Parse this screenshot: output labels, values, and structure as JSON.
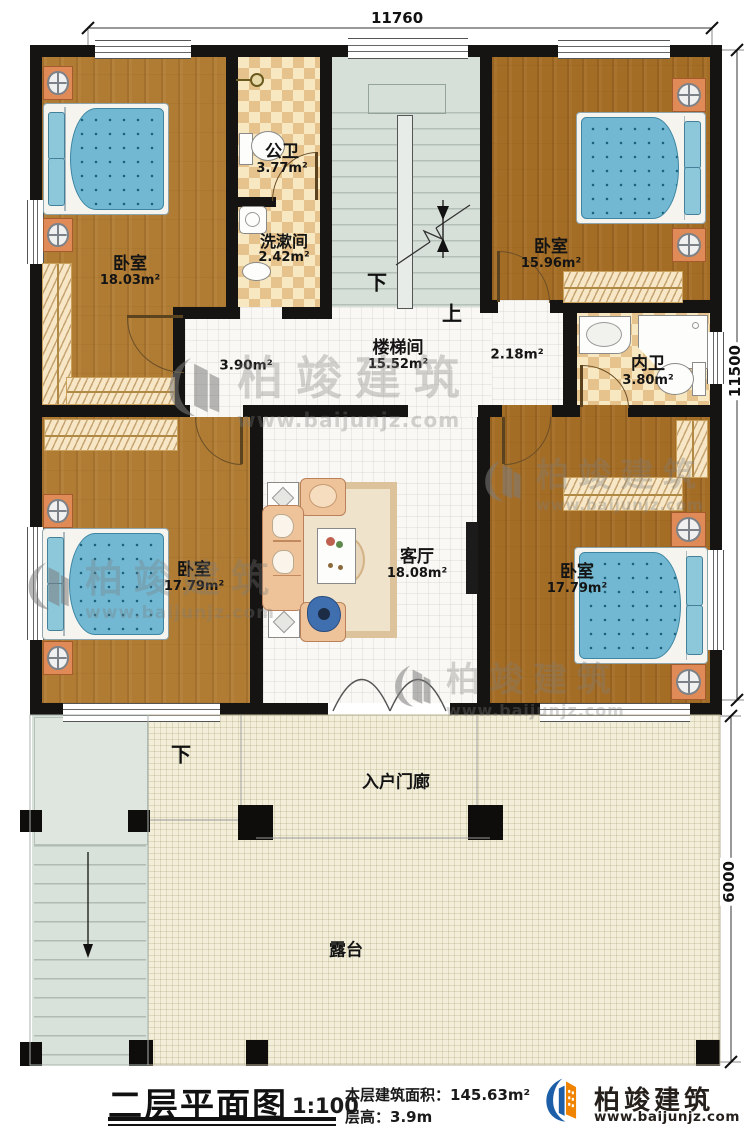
{
  "plan": {
    "title": "二层平面图",
    "scale": "1:100",
    "area_label": "本层建筑面积：",
    "area_value": "145.63m²",
    "height_label": "层高：",
    "height_value": "3.9m"
  },
  "brand": {
    "name": "柏竣建筑",
    "website": "www.baijunjz.com"
  },
  "watermark": {
    "name": "柏竣建筑",
    "website": "www.baijunjz.com"
  },
  "dimensions": {
    "top": "11760",
    "right_upper": "11500",
    "right_lower": "6000"
  },
  "rooms": {
    "bedroom_tl": {
      "name": "卧室",
      "area": "18.03m²"
    },
    "public_bath": {
      "name": "公卫",
      "area": "3.77m²"
    },
    "washroom": {
      "name": "洗漱间",
      "area": "2.42m²"
    },
    "bedroom_tr": {
      "name": "卧室",
      "area": "15.96m²"
    },
    "stair_hall": {
      "name": "楼梯间",
      "area": "15.52m²"
    },
    "corridor_left": {
      "area": "3.90m²"
    },
    "corridor_right": {
      "area": "2.18m²"
    },
    "ensuite_bath": {
      "name": "内卫",
      "area": "3.80m²"
    },
    "bedroom_bl": {
      "name": "卧室",
      "area": "17.79m²"
    },
    "living_room": {
      "name": "客厅",
      "area": "18.08m²"
    },
    "bedroom_br": {
      "name": "卧室",
      "area": "17.79m²"
    },
    "porch": {
      "name": "入户门廊"
    },
    "terrace": {
      "name": "露台"
    }
  },
  "stairs": {
    "down": "下",
    "up": "上",
    "outdoor_down": "下"
  }
}
